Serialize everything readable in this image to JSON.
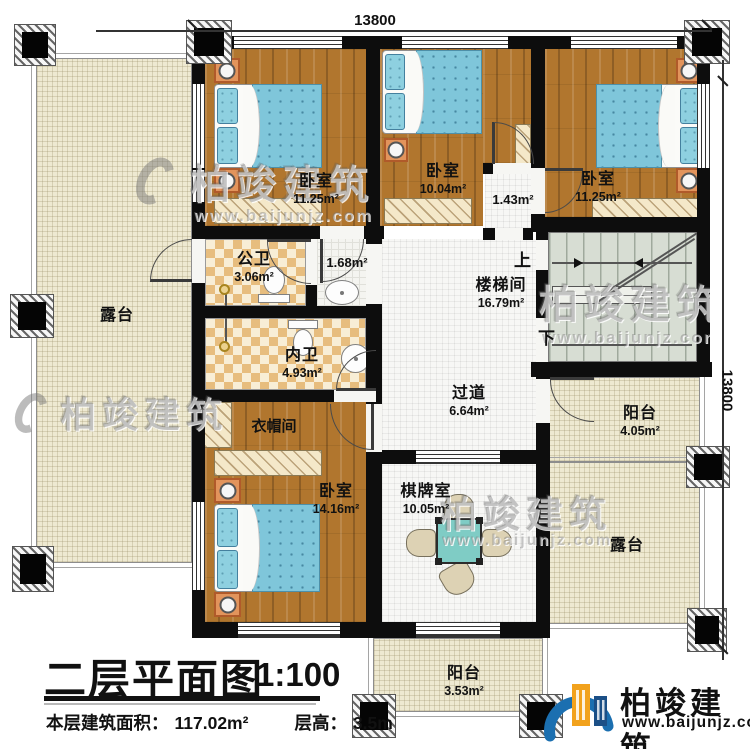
{
  "dims": {
    "top": "13800",
    "right": "13800"
  },
  "rooms": {
    "bedroom_top_left": {
      "name": "卧室",
      "area": "11.25m²"
    },
    "bedroom_top_mid": {
      "name": "卧室",
      "area": "10.04m²"
    },
    "bedroom_top_right": {
      "name": "卧室",
      "area": "11.25m²"
    },
    "hall_small": {
      "area": "1.43m²"
    },
    "wash_area": {
      "area": "1.68m²"
    },
    "public_bath": {
      "name": "公卫",
      "area": "3.06m²"
    },
    "private_bath": {
      "name": "内卫",
      "area": "4.93m²"
    },
    "stairwell": {
      "name": "楼梯间",
      "area": "16.79m²",
      "up": "上",
      "down": "下"
    },
    "corridor": {
      "name": "过道",
      "area": "6.64m²"
    },
    "cloakroom": {
      "name": "衣帽间"
    },
    "bedroom_bottom": {
      "name": "卧室",
      "area": "14.16m²"
    },
    "game_room": {
      "name": "棋牌室",
      "area": "10.05m²"
    },
    "balcony_right": {
      "name": "阳台",
      "area": "4.05m²"
    },
    "terrace_right": {
      "name": "露台"
    },
    "terrace_left": {
      "name": "露台"
    },
    "balcony_bottom": {
      "name": "阳台",
      "area": "3.53m²"
    }
  },
  "title_block": {
    "title": "二层平面图",
    "scale": "1:100",
    "area_label": "本层建筑面积：",
    "area_value": "117.02m²",
    "height_label": "层高：",
    "height_value": "3.5m"
  },
  "logo": {
    "name": "柏竣建筑",
    "url": "www.baijunjz.com"
  },
  "watermark": {
    "name": "柏竣建筑",
    "url": "www.baijunjz.com"
  },
  "colors": {
    "wall": "#0d0d0d",
    "wood_floor": "#b1762e",
    "bed_blue": "#7fc6da",
    "terrace_beige": "#eee9d1",
    "stair_green": "#d7ddd3",
    "bath_checker": "#e7bd7e",
    "logo_blue": "#1b6fb0",
    "logo_orange": "#f2a21d"
  }
}
